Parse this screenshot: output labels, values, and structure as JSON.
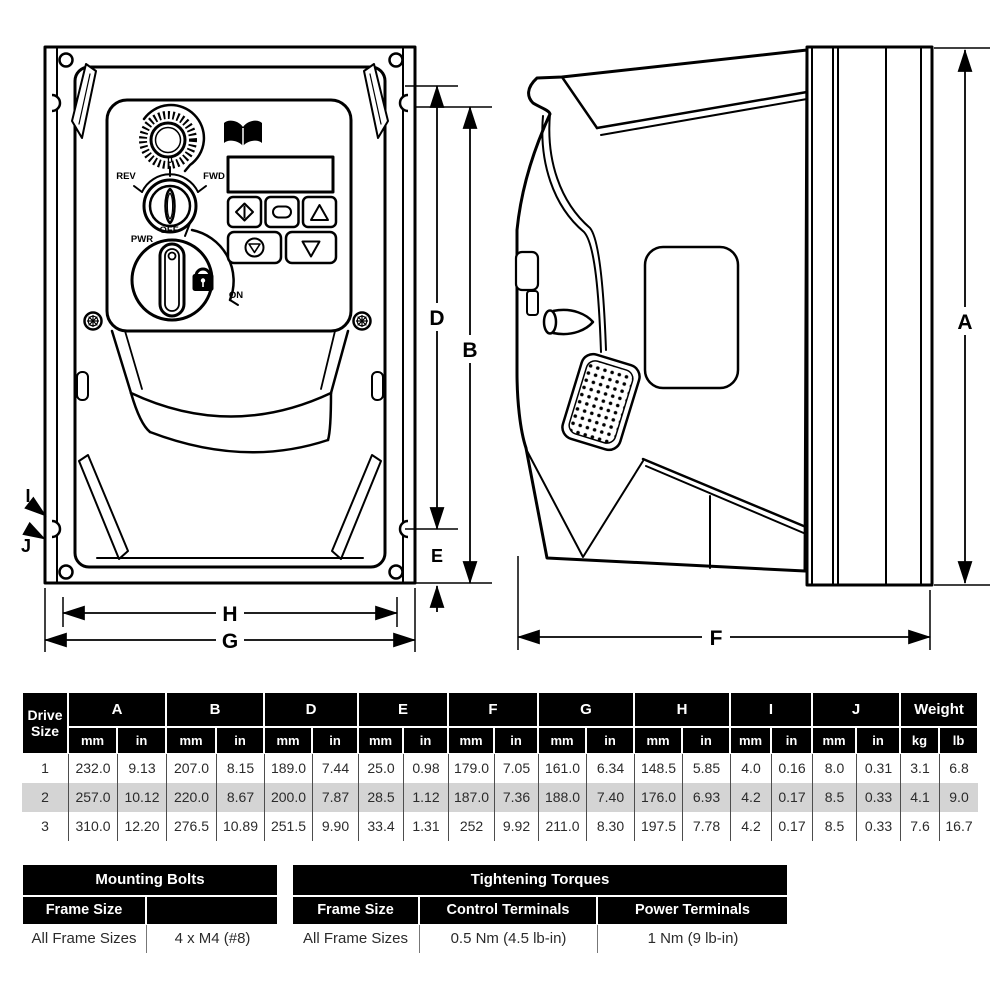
{
  "front_view": {
    "dim_labels": {
      "D": "D",
      "B": "B",
      "E": "E",
      "H": "H",
      "G": "G",
      "I": "I",
      "J": "J"
    },
    "control_labels": {
      "rev": "REV",
      "zero": "0",
      "fwd": "FWD",
      "pwr": "PWR",
      "off": "OFF",
      "on": "ON"
    }
  },
  "side_view": {
    "dim_labels": {
      "A": "A",
      "F": "F"
    }
  },
  "dim_table": {
    "corner_header": [
      "Drive",
      "Size"
    ],
    "groups": [
      "A",
      "B",
      "D",
      "E",
      "F",
      "G",
      "H",
      "I",
      "J",
      "Weight"
    ],
    "units": [
      "mm",
      "in",
      "mm",
      "in",
      "mm",
      "in",
      "mm",
      "in",
      "mm",
      "in",
      "mm",
      "in",
      "mm",
      "in",
      "mm",
      "in",
      "mm",
      "in",
      "kg",
      "lb"
    ],
    "rows": [
      {
        "size": "1",
        "highlight": false,
        "values": [
          "232.0",
          "9.13",
          "207.0",
          "8.15",
          "189.0",
          "7.44",
          "25.0",
          "0.98",
          "179.0",
          "7.05",
          "161.0",
          "6.34",
          "148.5",
          "5.85",
          "4.0",
          "0.16",
          "8.0",
          "0.31",
          "3.1",
          "6.8"
        ]
      },
      {
        "size": "2",
        "highlight": true,
        "values": [
          "257.0",
          "10.12",
          "220.0",
          "8.67",
          "200.0",
          "7.87",
          "28.5",
          "1.12",
          "187.0",
          "7.36",
          "188.0",
          "7.40",
          "176.0",
          "6.93",
          "4.2",
          "0.17",
          "8.5",
          "0.33",
          "4.1",
          "9.0"
        ]
      },
      {
        "size": "3",
        "highlight": false,
        "values": [
          "310.0",
          "12.20",
          "276.5",
          "10.89",
          "251.5",
          "9.90",
          "33.4",
          "1.31",
          "252",
          "9.92",
          "211.0",
          "8.30",
          "197.5",
          "7.78",
          "4.2",
          "0.17",
          "8.5",
          "0.33",
          "7.6",
          "16.7"
        ]
      }
    ]
  },
  "mounting_bolts": {
    "title": "Mounting Bolts",
    "col_headers": [
      "Frame Size",
      ""
    ],
    "row": [
      "All Frame Sizes",
      "4 x M4 (#8)"
    ]
  },
  "tightening_torques": {
    "title": "Tightening Torques",
    "col_headers": [
      "Frame Size",
      "Control Terminals",
      "Power Terminals"
    ],
    "row": [
      "All Frame Sizes",
      "0.5 Nm (4.5 lb-in)",
      "1 Nm (9 lb-in)"
    ]
  },
  "colors": {
    "header_bg": "#000000",
    "highlight_row": "#d4d4d4",
    "line": "#000000",
    "page_bg": "#ffffff"
  }
}
